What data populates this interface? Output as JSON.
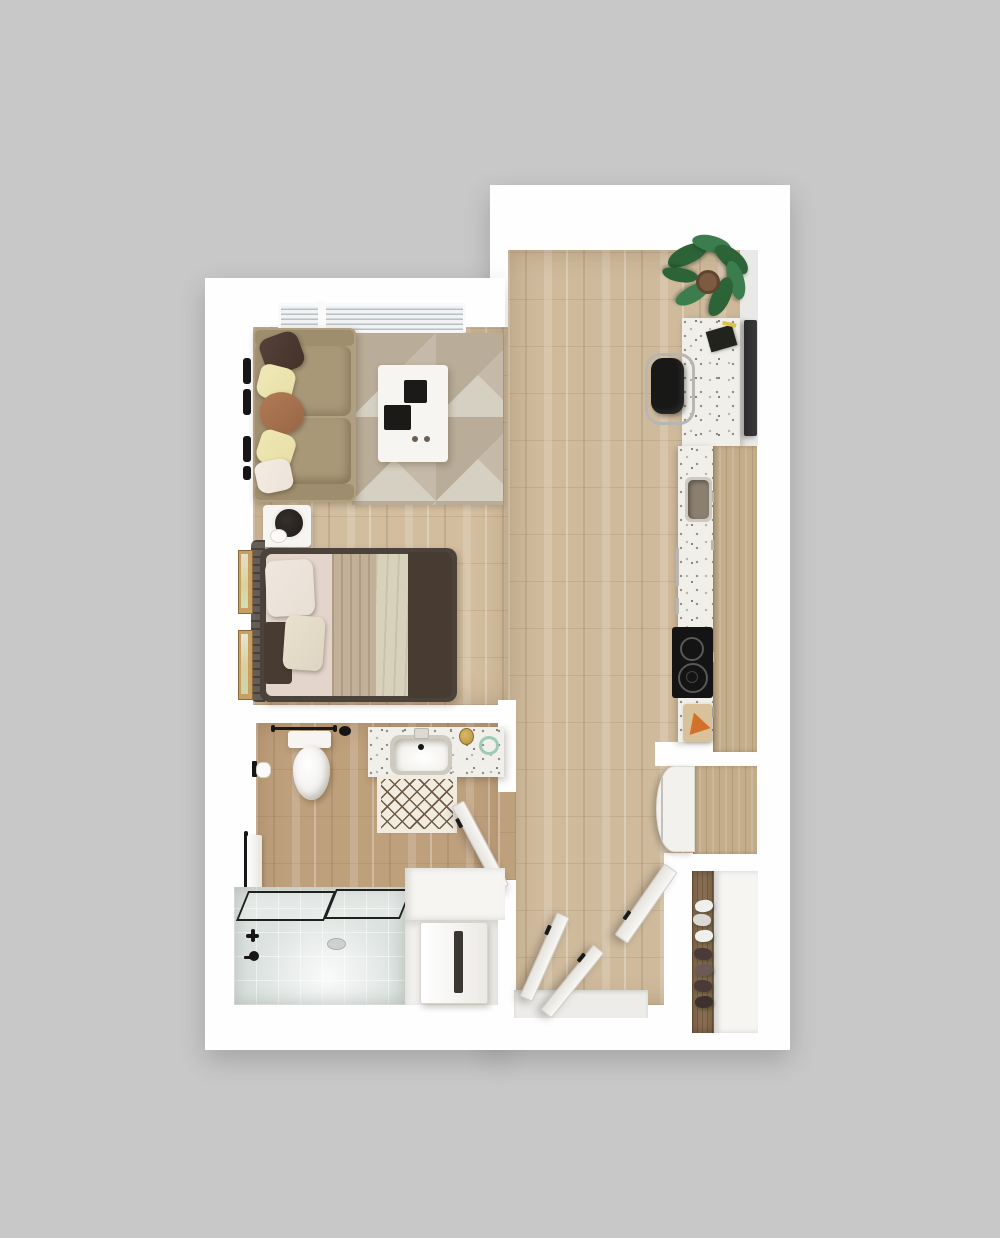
{
  "meta": {
    "kind": "floor-plan-render",
    "view": "top-down-3d",
    "unit": "studio-apartment"
  },
  "rooms": [
    {
      "name": "living-sleeping-area",
      "furniture": [
        "sofa",
        "throw-pillows",
        "area-rug",
        "coffee-table",
        "wall-hooks",
        "window-blinds",
        "nightstand",
        "table-lamp",
        "bed",
        "wall-art-frames"
      ]
    },
    {
      "name": "kitchen",
      "furniture": [
        "breakfast-bar",
        "bar-stool",
        "wall-tv",
        "potted-plant",
        "sink",
        "cooktop",
        "cutting-board",
        "upper-cabinets",
        "refrigerator"
      ]
    },
    {
      "name": "bathroom",
      "furniture": [
        "toilet",
        "towel-bar",
        "vanity-sink",
        "soap-dispenser",
        "tumbler",
        "bath-mat",
        "toilet-paper-holder",
        "hand-towel",
        "tub-shower",
        "shower-glass",
        "tub-faucet"
      ]
    },
    {
      "name": "laundry-nook",
      "furniture": [
        "counter",
        "washer-dryer"
      ]
    },
    {
      "name": "entry",
      "furniture": [
        "entry-door",
        "closet-door-left",
        "closet-door-middle",
        "threshold"
      ]
    },
    {
      "name": "entry-closet",
      "furniture": [
        "shoe-shelf",
        "shoes"
      ]
    }
  ],
  "colors": {
    "bg": "#c8c8c8",
    "wall": "#fefefe",
    "wallFace": "#e9e9e7",
    "floor": "#cfba9c",
    "floorLight": "#d2bd9e",
    "floorBath": "#bfa07c",
    "rugBase": "#d8d2c5",
    "rugTriA": "#b9ac99",
    "rugTriB": "#cfc7b7",
    "sofa": "#b0a080",
    "sofaSeat": "#a99878",
    "pillowBrown": "#43322a",
    "pillowCream": "#e7dfa6",
    "pillowRust": "#996747",
    "pillowBlush": "#ece3d9",
    "white": "#f6f5f2",
    "tray": "#1c1a18",
    "knob": "#6b5f52",
    "bedFrame": "#4a423b",
    "headboard": "#665e57",
    "sheet": "#e3d5cb",
    "duvetTan": "#c3b098",
    "duvetCream": "#d8d2bc",
    "throwDark": "#473b32",
    "bedPillowA": "#e8ded4",
    "bedPillowB": "#ded5c2",
    "lamp": "#1e1a17",
    "frameWood": "#c79f62",
    "frameArt": "#e4dfc8",
    "terrazzo": "#f1efe9",
    "cabinet": "#c3ad8b",
    "closetWood": "#8a6f52",
    "stool": "#181817",
    "chrome": "#b7b6b2",
    "tv": "#3a3a3d",
    "sinkBasin": "#8b7f70",
    "sinkRim": "#cfcac0",
    "cooktop": "#141414",
    "burner": "#585858",
    "fridge": "#f2f1ee",
    "plantA": "#2c6337",
    "plantB": "#3c7d4d",
    "pot": "#7c5b40",
    "tubGlass": "#dce2df",
    "tubFloor": "#e7ebe8",
    "tubLine": "#20201f",
    "mat": "#f2ebdf",
    "matLine": "#6e5b47",
    "gold": "#b3903f",
    "glassGreen": "#9fc9b9",
    "door": "#f8f7f4",
    "doorEdge": "#cfccc6",
    "handle": "#1a1a1a",
    "orange": "#d2702c",
    "board": "#d9c29a",
    "bookBlack": "#23231e",
    "bookYellow": "#d9c24a",
    "shoeA": "#efefec",
    "shoeB": "#4a3a38",
    "blackAccent": "#161616",
    "windowGlass": "#f0f2f3",
    "windowSlat": "#b9c0c4"
  }
}
